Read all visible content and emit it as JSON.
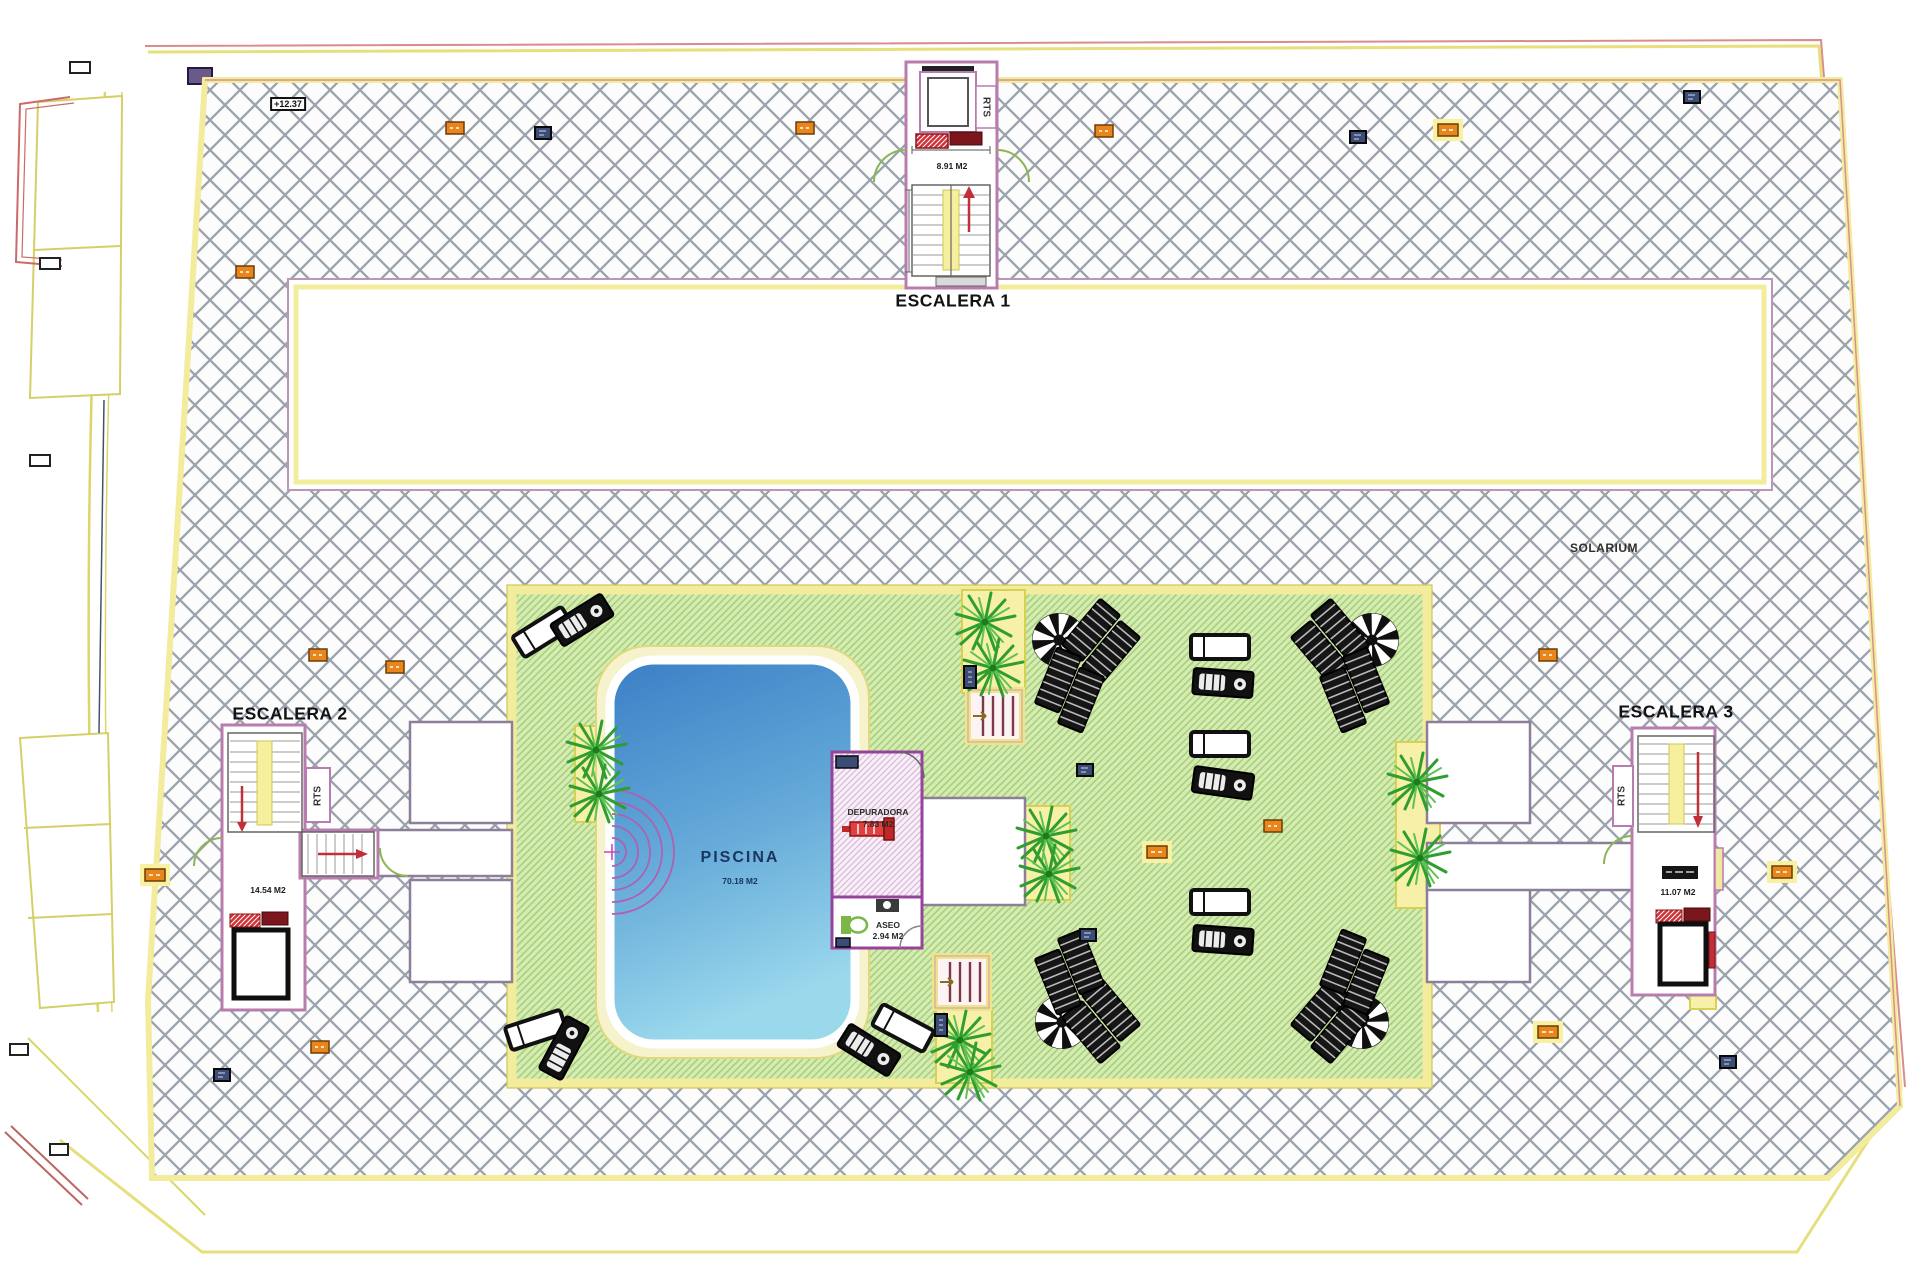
{
  "plan": {
    "zone_label": "SOLARIUM",
    "level_marker": "+12.37",
    "pool": {
      "label": "PISCINA",
      "area": "70.18 M2"
    },
    "rooms": [
      {
        "label": "DEPURADORA",
        "area": "7.83 M2"
      },
      {
        "label": "ASEO",
        "area": "2.94 M2"
      }
    ],
    "stairs": [
      {
        "label": "ESCALERA 1",
        "area": "8.91 M2",
        "shaft_label": "RTS"
      },
      {
        "label": "ESCALERA 2",
        "area": "14.54 M2",
        "shaft_label": "RTS"
      },
      {
        "label": "ESCALERA 3",
        "area": "11.07 M2",
        "shaft_label": "RTS"
      }
    ],
    "colors": {
      "hatch_line": "#9aa2ab",
      "deck_green": "#d5ecb0",
      "deck_hatch_line": "#a6cd7e",
      "pool_top": "#3b7fc6",
      "pool_bottom": "#9ad8ec",
      "wall_purple": "#b87dae",
      "border_yellow": "#f2ec9c",
      "marker_orange": "#e8861c",
      "marker_navy": "#3b4d76",
      "accent_red": "#c03038",
      "door_green": "#8ab653"
    }
  }
}
